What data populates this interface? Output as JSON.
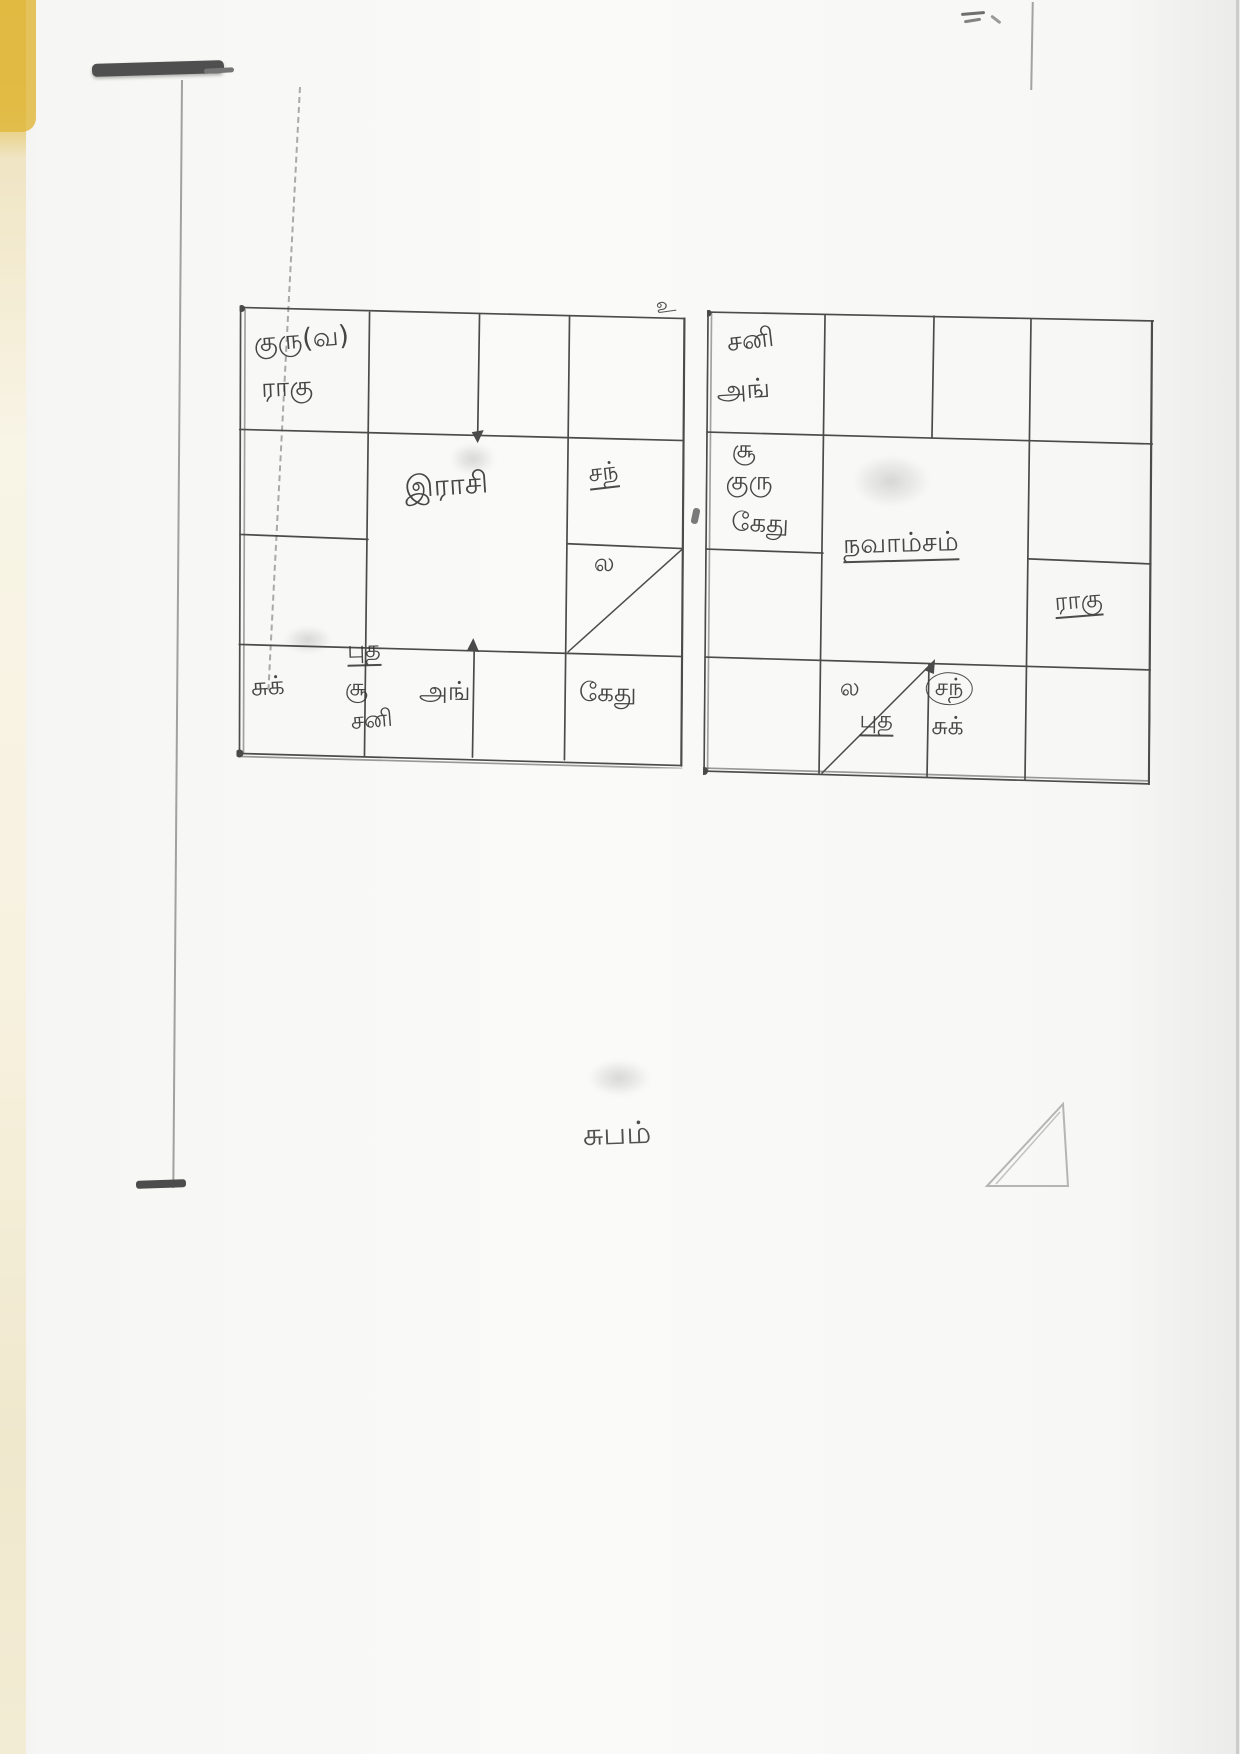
{
  "page": {
    "invocation_symbol": "உ",
    "closing_text": "சுபம்"
  },
  "rasi_chart": {
    "title": "இராசி",
    "houses": {
      "top_left": [
        "குரு(வ)",
        "ராகு"
      ],
      "right_middle": [
        "சந்"
      ],
      "right_lower": [
        "ல"
      ],
      "bottom_far_left": [
        "சுக்"
      ],
      "bottom_left_center": [
        "புத",
        "சூ",
        "சனி"
      ],
      "bottom_right_center": [
        "அங்"
      ],
      "bottom_far_right": [
        "கேது"
      ]
    }
  },
  "navamsam_chart": {
    "title": "நவாம்சம்",
    "houses": {
      "top_left": [
        "சனி",
        "அங்"
      ],
      "left_middle": [
        "சூ",
        "குரு",
        "கேது"
      ],
      "right_lower": [
        "ராகு"
      ],
      "bottom_left_center": [
        "ல",
        "புத"
      ],
      "bottom_right_center": [
        "சந்",
        "சுக்"
      ]
    }
  }
}
